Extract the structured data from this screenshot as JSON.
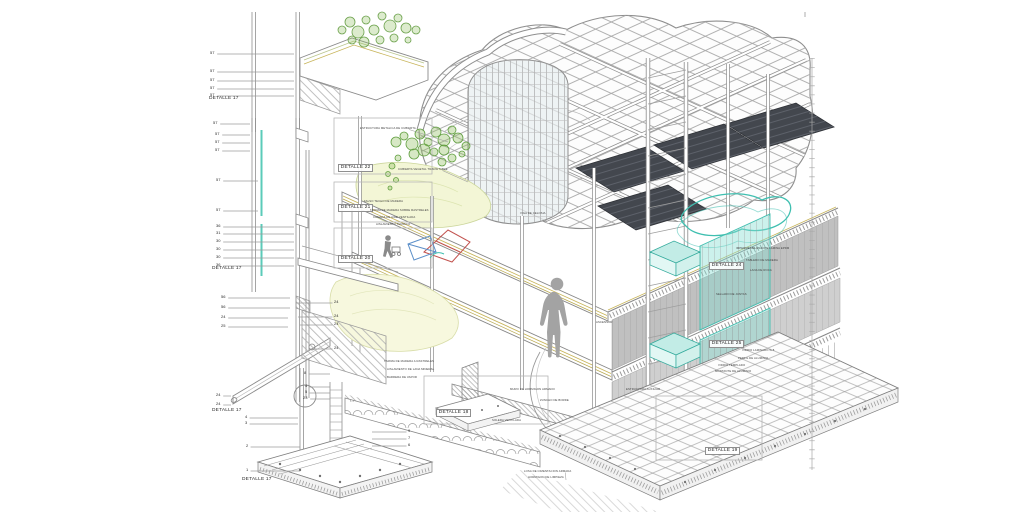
{
  "drawing": {
    "language": "es",
    "type": "constructive-axonometric-section"
  },
  "colors": {
    "line_gray": "#8f8f8f",
    "light_gray": "#c4c4c4",
    "soffit_gray": "#c0c0c0",
    "glass_teal_stroke": "#3fbfb0",
    "glass_teal_fill": "#8fe0d5",
    "plant_green": "#6aa04a",
    "ground_yellow_green": "#f3f6d6",
    "floor_layer_yellow": "#c8b55b",
    "solar_panel_dark": "#43474e",
    "wire_red": "#c2524e",
    "wire_blue": "#5b8fc9",
    "silhouette_gray": "#a3a3a3"
  },
  "detail_labels": [
    {
      "t": "DETALLE 17",
      "x": 209,
      "y": 100,
      "boxed": false
    },
    {
      "t": "DETALLE 17",
      "x": 212,
      "y": 270,
      "boxed": false
    },
    {
      "t": "DETALLE 17",
      "x": 212,
      "y": 412,
      "boxed": false
    },
    {
      "t": "DETALLE 17",
      "x": 242,
      "y": 481,
      "boxed": false
    },
    {
      "t": "DETALLE 22",
      "x": 338,
      "y": 167,
      "boxed": true
    },
    {
      "t": "DETALLE 21",
      "x": 338,
      "y": 207,
      "boxed": true
    },
    {
      "t": "DETALLE 20",
      "x": 338,
      "y": 258,
      "boxed": true
    },
    {
      "t": "DETALLE 24",
      "x": 709,
      "y": 265,
      "boxed": true
    },
    {
      "t": "DETALLE 25",
      "x": 709,
      "y": 343,
      "boxed": true
    },
    {
      "t": "DETALLE 18",
      "x": 436,
      "y": 412,
      "boxed": true
    },
    {
      "t": "DETALLE 19",
      "x": 705,
      "y": 450,
      "boxed": true
    }
  ],
  "leader_numbers": [
    {
      "t": "57",
      "x": 210,
      "y": 53,
      "tx": 294
    },
    {
      "t": "57",
      "x": 210,
      "y": 71,
      "tx": 294
    },
    {
      "t": "57",
      "x": 210,
      "y": 80,
      "tx": 294
    },
    {
      "t": "57",
      "x": 210,
      "y": 88,
      "tx": 294
    },
    {
      "t": "57",
      "x": 210,
      "y": 95,
      "tx": 294
    },
    {
      "t": "57",
      "x": 213,
      "y": 123,
      "tx": 250
    },
    {
      "t": "57",
      "x": 215,
      "y": 134,
      "tx": 250
    },
    {
      "t": "57",
      "x": 215,
      "y": 142,
      "tx": 250
    },
    {
      "t": "57",
      "x": 215,
      "y": 150,
      "tx": 250
    },
    {
      "t": "57",
      "x": 216,
      "y": 180,
      "tx": 258
    },
    {
      "t": "57",
      "x": 216,
      "y": 210,
      "tx": 258
    },
    {
      "t": "36",
      "x": 216,
      "y": 226,
      "tx": 294
    },
    {
      "t": "31",
      "x": 216,
      "y": 233,
      "tx": 294
    },
    {
      "t": "30",
      "x": 216,
      "y": 241,
      "tx": 294
    },
    {
      "t": "30",
      "x": 216,
      "y": 249,
      "tx": 294
    },
    {
      "t": "30",
      "x": 216,
      "y": 257,
      "tx": 294
    },
    {
      "t": "36",
      "x": 216,
      "y": 265,
      "tx": 294
    },
    {
      "t": "56",
      "x": 221,
      "y": 297,
      "tx": 290
    },
    {
      "t": "56",
      "x": 221,
      "y": 307,
      "tx": 290
    },
    {
      "t": "24",
      "x": 221,
      "y": 317,
      "tx": 288
    },
    {
      "t": "25",
      "x": 221,
      "y": 326,
      "tx": 288
    },
    {
      "t": "24",
      "x": 216,
      "y": 395,
      "tx": 231
    },
    {
      "t": "24",
      "x": 216,
      "y": 404,
      "tx": 231
    },
    {
      "t": "24",
      "x": 334,
      "y": 302,
      "tx": 296
    },
    {
      "t": "24",
      "x": 334,
      "y": 316,
      "tx": 298
    },
    {
      "t": "24",
      "x": 334,
      "y": 324,
      "tx": 300
    },
    {
      "t": "24",
      "x": 334,
      "y": 348,
      "tx": 310
    },
    {
      "t": "8",
      "x": 304,
      "y": 373,
      "tx": 330
    },
    {
      "t": "4",
      "x": 305,
      "y": 386,
      "tx": 330
    },
    {
      "t": "5",
      "x": 305,
      "y": 392,
      "tx": 330
    },
    {
      "t": "23",
      "x": 303,
      "y": 398,
      "tx": 330
    },
    {
      "t": "4",
      "x": 245,
      "y": 417,
      "tx": 298
    },
    {
      "t": "3",
      "x": 245,
      "y": 423,
      "tx": 298
    },
    {
      "t": "2",
      "x": 246,
      "y": 446,
      "tx": 300
    },
    {
      "t": "1",
      "x": 246,
      "y": 470,
      "tx": 300
    },
    {
      "t": "9",
      "x": 408,
      "y": 431,
      "tx": 372
    },
    {
      "t": "7",
      "x": 408,
      "y": 438,
      "tx": 372
    },
    {
      "t": "6",
      "x": 408,
      "y": 445,
      "tx": 372
    }
  ],
  "annotations": [
    {
      "t": "ESTRUCTURA METALICA DE CUBIERTA",
      "x": 360,
      "y": 129,
      "tx": 448,
      "ty": 142
    },
    {
      "t": "CUBIERTA VEGETAL TRANSITABLE",
      "x": 398,
      "y": 170,
      "tx": 468,
      "ty": 182
    },
    {
      "t": "FALSO TECHO DE MADERA",
      "x": 364,
      "y": 202
    },
    {
      "t": "TARIMA DE MADERA SOBRE RASTRELES",
      "x": 370,
      "y": 211
    },
    {
      "t": "CAMARA DE AIRE VENTILADA",
      "x": 373,
      "y": 218
    },
    {
      "t": "AISLAMIENTO TERMICO",
      "x": 376,
      "y": 225
    },
    {
      "t": "VIGA DE CELOSIA",
      "x": 520,
      "y": 214
    },
    {
      "t": "IMPERMEABILIZACION LAMINA EPDM",
      "x": 736,
      "y": 249
    },
    {
      "t": "TABLERO DE MADERA",
      "x": 746,
      "y": 261
    },
    {
      "t": "LANA DE ROCA",
      "x": 750,
      "y": 271
    },
    {
      "t": "SELLADO DE JUNTAS",
      "x": 716,
      "y": 295
    },
    {
      "t": "VIDRIO LAMINADO 5+5",
      "x": 742,
      "y": 351
    },
    {
      "t": "PERFIL DE ALUMINIO",
      "x": 738,
      "y": 359
    },
    {
      "t": "MURO DE HORMIGON ARMADO",
      "x": 510,
      "y": 390
    },
    {
      "t": "ZUNCHO DE BORDE",
      "x": 540,
      "y": 401
    },
    {
      "t": "SOLERA VENTILADA",
      "x": 492,
      "y": 421
    },
    {
      "t": "LOSA DE CIMENTACION ARMADA",
      "x": 524,
      "y": 472,
      "tx": 566,
      "ty": 480
    },
    {
      "t": "HORMIGON DE LIMPIEZA",
      "x": 528,
      "y": 478
    },
    {
      "t": "TARIMA DE MADERA A RASTRELES",
      "x": 384,
      "y": 362
    },
    {
      "t": "AISLAMIENTO DE LANA MINERAL",
      "x": 387,
      "y": 370
    },
    {
      "t": "BARRERA DE VAPOR",
      "x": 387,
      "y": 378
    },
    {
      "t": "ASCENSOR",
      "x": 596,
      "y": 323
    },
    {
      "t": "ESTRUCTURA AUXILIAR",
      "x": 626,
      "y": 390
    },
    {
      "t": "VIDRIO TEMPLADO",
      "x": 718,
      "y": 366
    },
    {
      "t": "MONTANTE DE ALUMINIO",
      "x": 715,
      "y": 372
    }
  ]
}
